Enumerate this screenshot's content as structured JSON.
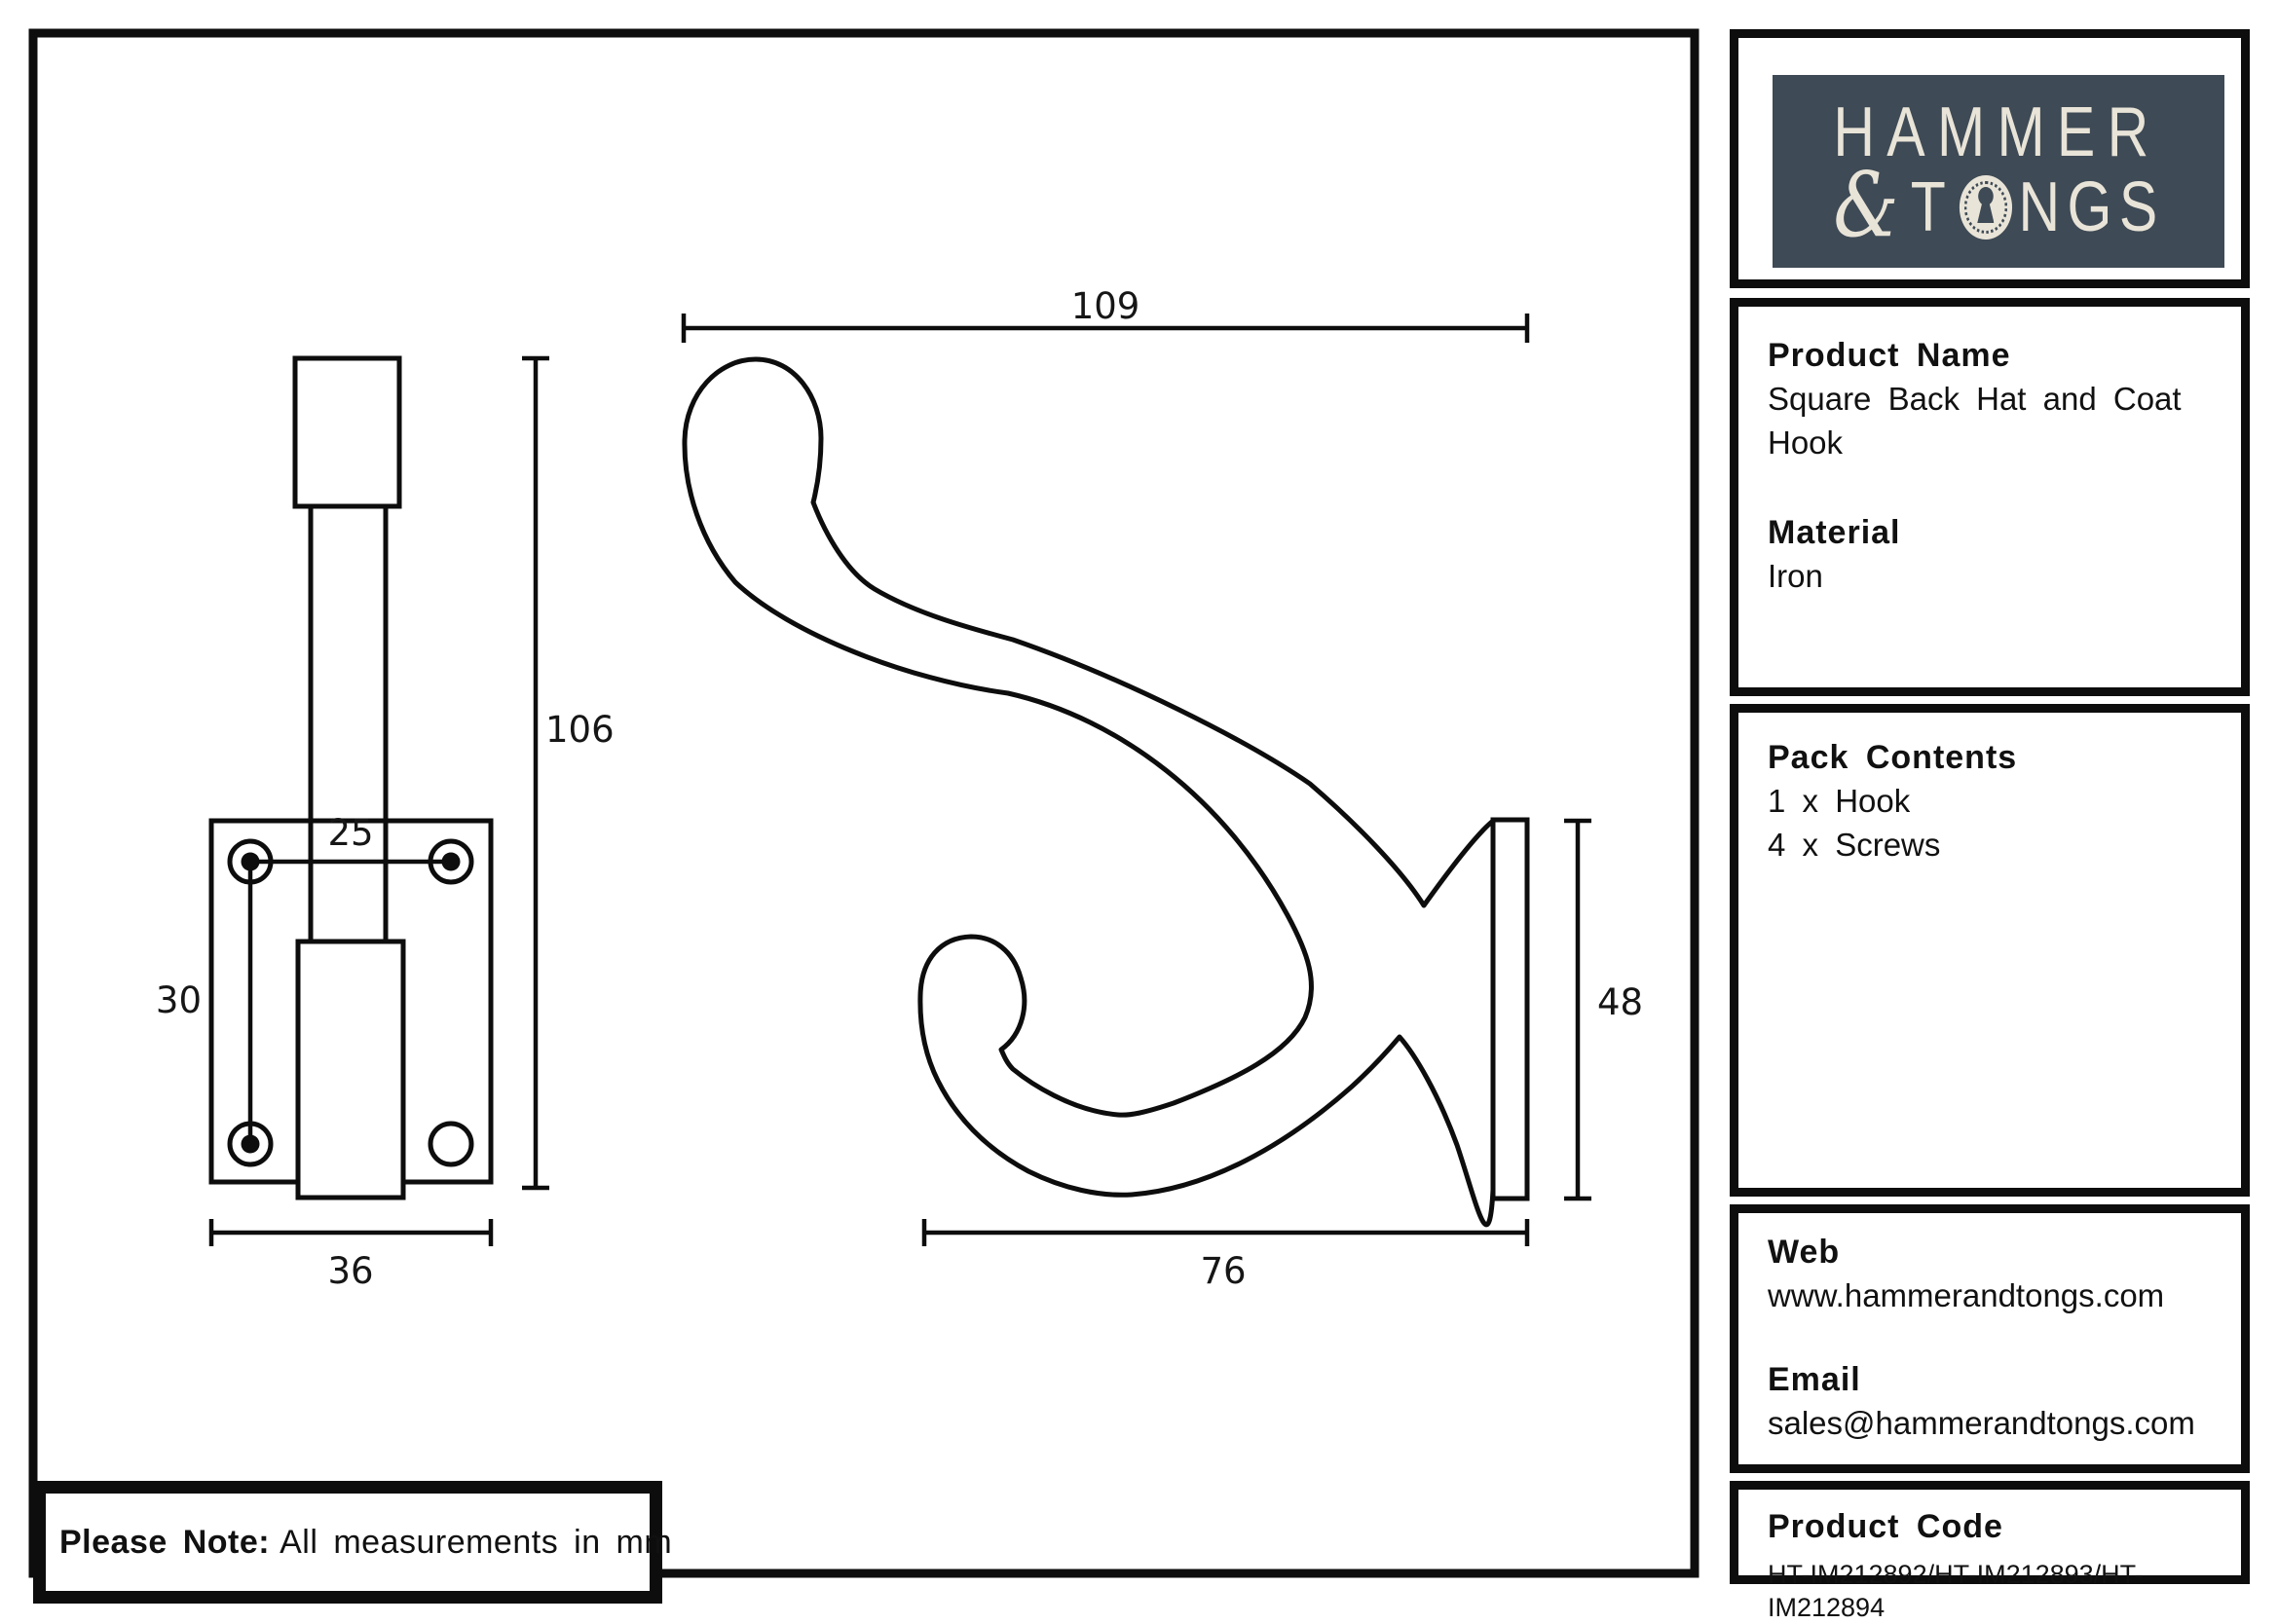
{
  "page": {
    "note_bold": "Please Note:",
    "note_text": "All measurements in mm"
  },
  "logo": {
    "brand_bg_color": "#3e4a55",
    "brand_fg_color": "#e9e4d8",
    "line1": "HAMMER",
    "ampersand": "&",
    "line2_before": "T",
    "line2_after": "NGS",
    "keyhole_icon": "keyhole-icon"
  },
  "sidebar": {
    "product": {
      "heading": "Product Name",
      "value_line1": "Square Back Hat and Coat",
      "value_line2": "Hook",
      "material_heading": "Material",
      "material_value": "Iron"
    },
    "pack": {
      "heading": "Pack Contents",
      "items": [
        "1 x Hook",
        "4 x Screws"
      ]
    },
    "contact": {
      "web_heading": "Web",
      "web_value": "www.hammerandtongs.com",
      "email_heading": "Email",
      "email_value": "sales@hammerandtongs.com"
    },
    "code": {
      "heading": "Product Code",
      "value": "HT-IM212892/HT-IM212893/HT-IM212894"
    }
  },
  "drawing": {
    "units": "mm",
    "front_view": {
      "overall_height": "106",
      "hole_spacing_horizontal": "25",
      "hole_spacing_vertical": "30",
      "plate_width": "36"
    },
    "side_view": {
      "overall_length": "109",
      "plate_height": "48",
      "projection": "76"
    }
  }
}
